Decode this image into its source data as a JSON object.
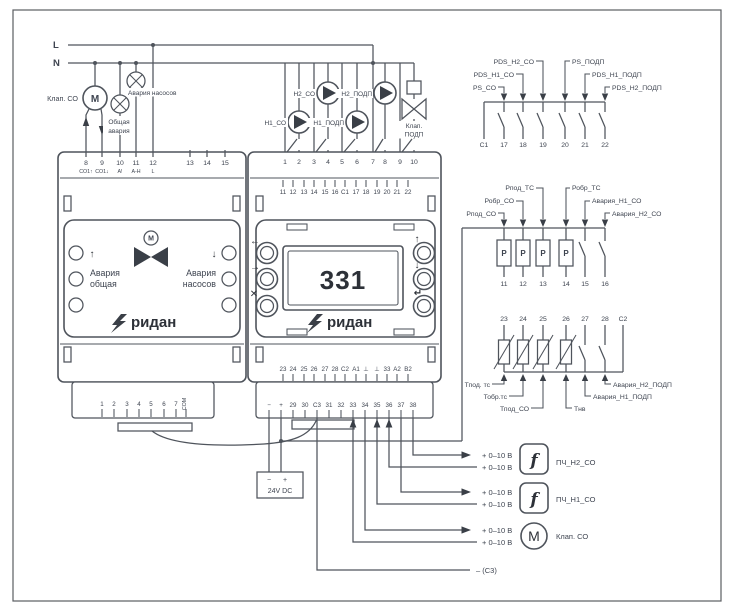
{
  "colors": {
    "line": "#4f545c",
    "text": "#3e4450",
    "dark": "#2d3138"
  },
  "power": {
    "l": "L",
    "n": "N"
  },
  "field_left": {
    "valve_co_label": "Клап. СО",
    "motor_letter": "M",
    "lamp_general_lines": [
      "Общая",
      "авария"
    ],
    "lamp_pumps_label": "Авария насосов"
  },
  "pump_block": {
    "pump_labels": [
      "Н1_СО",
      "Н2_СО",
      "Н1_ПОДП",
      "Н2_ПОДП"
    ],
    "valve_label_lines": [
      "Клап.",
      "ПОДП"
    ]
  },
  "controller": {
    "left": {
      "top_terminals": [
        "8",
        "9",
        "10",
        "11",
        "12",
        "13",
        "14",
        "15"
      ],
      "top_sub_labels": [
        "СО1↑",
        "СО1↓",
        "А!",
        "А-Н",
        "L"
      ],
      "arrow_up": "↑",
      "arrow_down": "↓",
      "alarm_general_lines": [
        "Авария",
        "общая"
      ],
      "alarm_pumps_lines": [
        "Авария",
        "насосов"
      ],
      "valve_motor_letter": "M",
      "brand": "ридан",
      "bottom_terminals": [
        "1",
        "2",
        "3",
        "4",
        "5",
        "6",
        "7"
      ],
      "bottom_com": "СОМ"
    },
    "right": {
      "row1": [
        "1",
        "2",
        "3",
        "4",
        "5",
        "6",
        "7",
        "8",
        "9",
        "10"
      ],
      "row2": [
        "11",
        "12",
        "13",
        "14",
        "15",
        "16",
        "C1",
        "17",
        "18",
        "19",
        "20",
        "21",
        "22"
      ],
      "row3": [
        "23",
        "24",
        "25",
        "26",
        "27",
        "28",
        "C2",
        "A1",
        "⊥",
        "⊥",
        "33",
        "A2",
        "B2"
      ],
      "row4": [
        "−",
        "+",
        "29",
        "30",
        "C3",
        "31",
        "32",
        "33",
        "34",
        "35",
        "36",
        "37",
        "38"
      ],
      "display_value": "331",
      "brand": "ридан",
      "btn_icons_left": [
        "←",
        "→",
        "✕"
      ],
      "btn_icons_right": [
        "↑",
        "↓",
        "↵"
      ]
    }
  },
  "psu": {
    "minus": "−",
    "plus": "+",
    "label": "24V DC"
  },
  "outputs": {
    "rows": [
      {
        "a": "+ 0–10 В",
        "b": "+ 0–10 В",
        "symbol": "f",
        "label": "ПЧ_Н2_СО"
      },
      {
        "a": "+ 0–10 В",
        "b": "+ 0–10 В",
        "symbol": "f",
        "label": "ПЧ_Н1_СО"
      },
      {
        "a": "+ 0–10 В",
        "b": "+ 0–10 В",
        "symbol": "M",
        "label": "Клап. СО"
      }
    ],
    "ground_ref": "– (С3)"
  },
  "block_ps": {
    "labels_left": [
      "PS_CO",
      "PDS_H1_CO",
      "PDS_H2_CO"
    ],
    "labels_right": [
      "PS_ПОДП",
      "PDS_H1_ПОДП",
      "PDS_H2_ПОДП"
    ],
    "terminals": [
      "C1",
      "17",
      "18",
      "19",
      "20",
      "21",
      "22"
    ]
  },
  "block_pressure": {
    "labels_left": [
      "Рпод_СО",
      "Робр_СО",
      "Рпод_ТС"
    ],
    "labels_right": [
      "Робр_ТС",
      "Авария_Н1_СО",
      "Авария_Н2_СО"
    ],
    "sensor_letter": "P",
    "terminals": [
      "11",
      "12",
      "13",
      "14",
      "15",
      "16"
    ]
  },
  "block_temp": {
    "terminals": [
      "23",
      "24",
      "25",
      "26",
      "27",
      "28",
      "C2"
    ],
    "labels_left": [
      "Тпод. тс",
      "Тобр.тс",
      "Тпод_СО"
    ],
    "labels_right": [
      "Тнв",
      "Авария_Н1_ПОДП",
      "Авария_Н2_ПОДП"
    ]
  }
}
